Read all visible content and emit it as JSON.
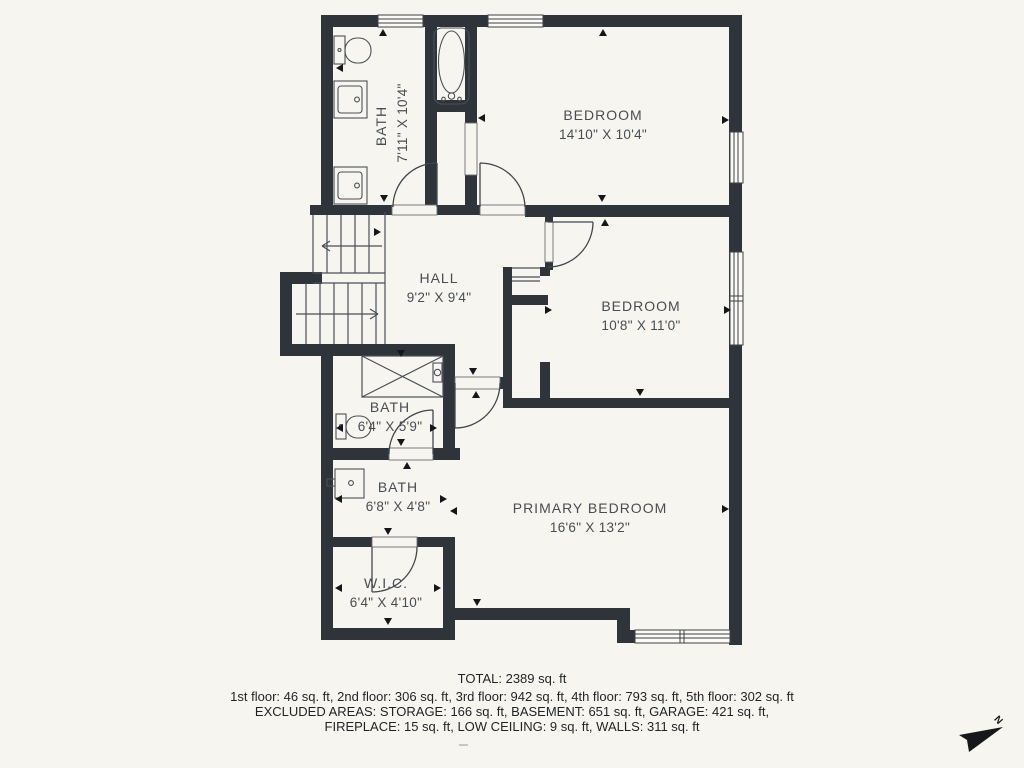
{
  "floorplan": {
    "rooms": [
      {
        "name": "BATH",
        "dims": "7'11\" X 10'4\""
      },
      {
        "name": "BEDROOM",
        "dims": "14'10\" X 10'4\""
      },
      {
        "name": "HALL",
        "dims": "9'2\" X 9'4\""
      },
      {
        "name": "BEDROOM",
        "dims": "10'8\" X 11'0\""
      },
      {
        "name": "BATH",
        "dims": "6'4\" X 5'9\""
      },
      {
        "name": "BATH",
        "dims": "6'8\" X 4'8\""
      },
      {
        "name": "PRIMARY BEDROOM",
        "dims": "16'6\" X 13'2\""
      },
      {
        "name": "W.I.C.",
        "dims": "6'4\" X 4'10\""
      }
    ],
    "north_label": "N"
  },
  "footer": {
    "total": "TOTAL: 2389 sq. ft",
    "line1": "1st floor: 46 sq. ft, 2nd floor: 306 sq. ft, 3rd floor: 942 sq. ft, 4th floor: 793 sq. ft, 5th floor: 302 sq. ft",
    "line2": "EXCLUDED AREAS: STORAGE: 166 sq. ft, BASEMENT: 651 sq. ft, GARAGE: 421 sq. ft,",
    "line3": "FIREPLACE: 15 sq. ft, LOW CEILING: 9 sq. ft, WALLS: 311 sq. ft"
  },
  "colors": {
    "wall": "#2e343a",
    "background": "#f7f5ef",
    "line": "#4a5057",
    "text": "#474d53"
  }
}
